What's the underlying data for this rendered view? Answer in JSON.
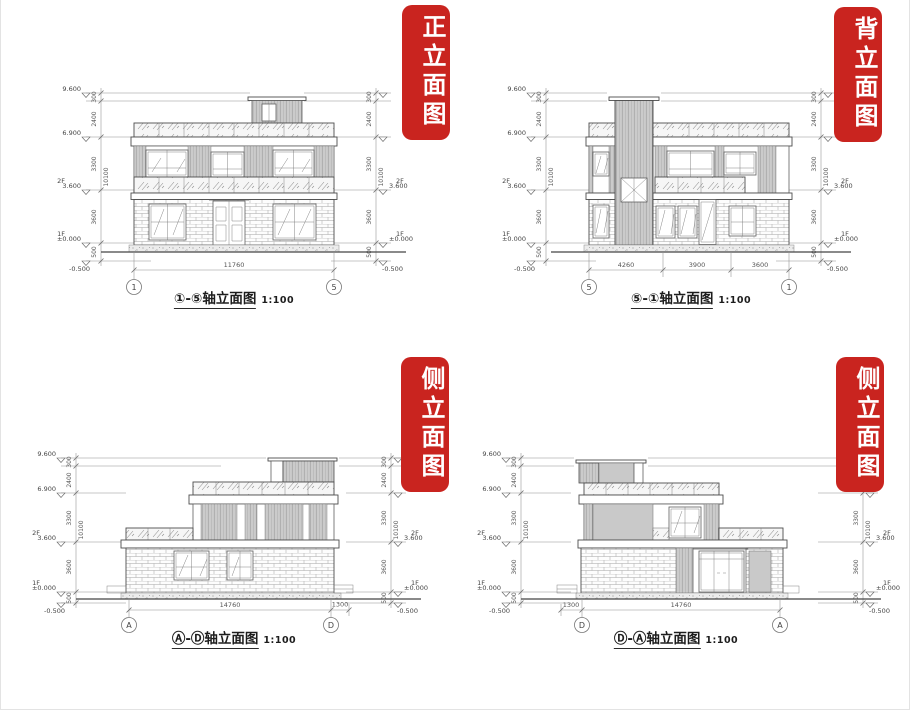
{
  "colors": {
    "banner_red": "#c9241f",
    "banner_text": "#ffffff",
    "line": "#5f5f5f",
    "dim_line": "#8f8f8f",
    "panel_gray": "#c9c9c9",
    "paper": "#ffffff"
  },
  "levels": {
    "e96": "9.600",
    "e69": "6.900",
    "e36": "3.600",
    "e00": "±0.000",
    "em05": "-0.500",
    "f2": "2F",
    "f1": "1F",
    "d300": "300",
    "d2400": "2400",
    "d3300": "3300",
    "d3600": "3600",
    "d500": "500",
    "total": "10100"
  },
  "panels": [
    {
      "banner": "正立面图",
      "caption": "①-⑤轴立面图",
      "scale": "1:100",
      "axisL": "1",
      "axisR": "5",
      "hdims": [
        "11760"
      ]
    },
    {
      "banner": "背立面图",
      "caption": "⑤-①轴立面图",
      "scale": "1:100",
      "axisL": "5",
      "axisR": "1",
      "hdims": [
        "4260",
        "3900",
        "3600"
      ]
    },
    {
      "banner": "侧立面图",
      "caption": "Ⓐ-Ⓓ轴立面图",
      "scale": "1:100",
      "axisL": "A",
      "axisR": "D",
      "hdims": [
        "14760",
        "1300"
      ]
    },
    {
      "banner": "侧立面图",
      "caption": "Ⓓ-Ⓐ轴立面图",
      "scale": "1:100",
      "axisL": "D",
      "axisR": "A",
      "hdims": [
        "1300",
        "14760"
      ]
    }
  ]
}
